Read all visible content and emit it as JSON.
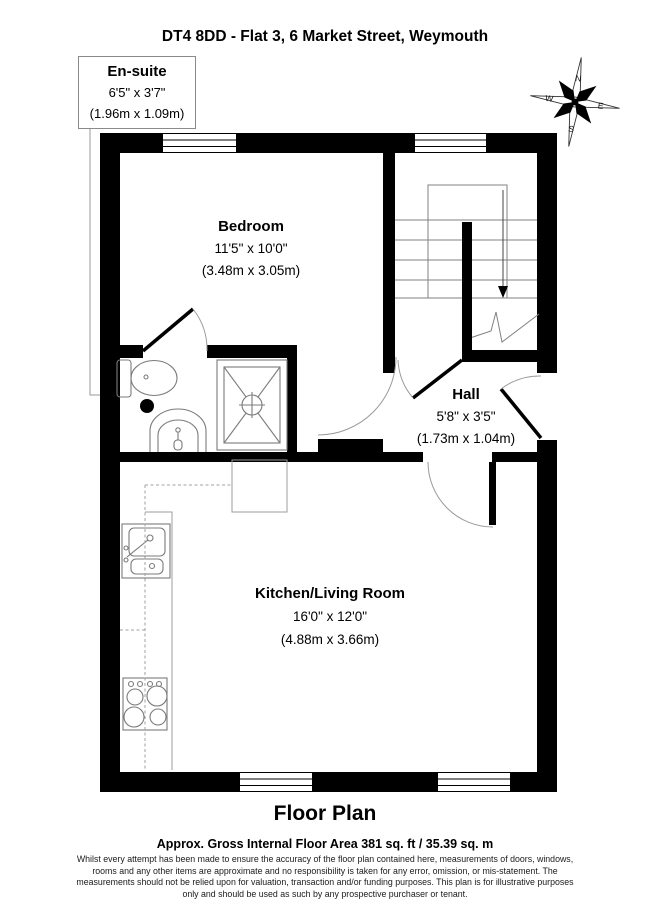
{
  "title": "DT4 8DD - Flat 3, 6 Market Street, Weymouth",
  "rooms": {
    "ensuite": {
      "name": "En-suite",
      "size_imperial": "6'5\" x 3'7\"",
      "size_metric": "(1.96m x 1.09m)"
    },
    "bedroom": {
      "name": "Bedroom",
      "size_imperial": "11'5\" x 10'0\"",
      "size_metric": "(3.48m x 3.05m)"
    },
    "hall": {
      "name": "Hall",
      "size_imperial": "5'8\" x 3'5\"",
      "size_metric": "(1.73m x 1.04m)"
    },
    "kitchen_living": {
      "name": "Kitchen/Living Room",
      "size_imperial": "16'0\" x 12'0\"",
      "size_metric": "(4.88m x 3.66m)"
    }
  },
  "compass": {
    "north": "N",
    "east": "E",
    "south": "S",
    "west": "W"
  },
  "footer": {
    "plan_title": "Floor Plan",
    "area_line": "Approx. Gross Internal Floor Area 381 sq. ft / 35.39 sq. m",
    "disclaimer_lines": [
      "Whilst every attempt has been made to ensure the accuracy of the floor plan contained here, measurements of doors, windows,",
      "rooms and any other items are approximate and no responsibility is taken for any error, omission, or mis-statement. The",
      "measurements should not be relied upon for valuation, transaction and/or funding purposes. This plan is for illustrative purposes",
      "only and should be used as such by any prospective purchaser or tenant."
    ]
  },
  "colors": {
    "wall": "#000000",
    "fixture_line": "#7b7b7b",
    "background": "#ffffff"
  }
}
